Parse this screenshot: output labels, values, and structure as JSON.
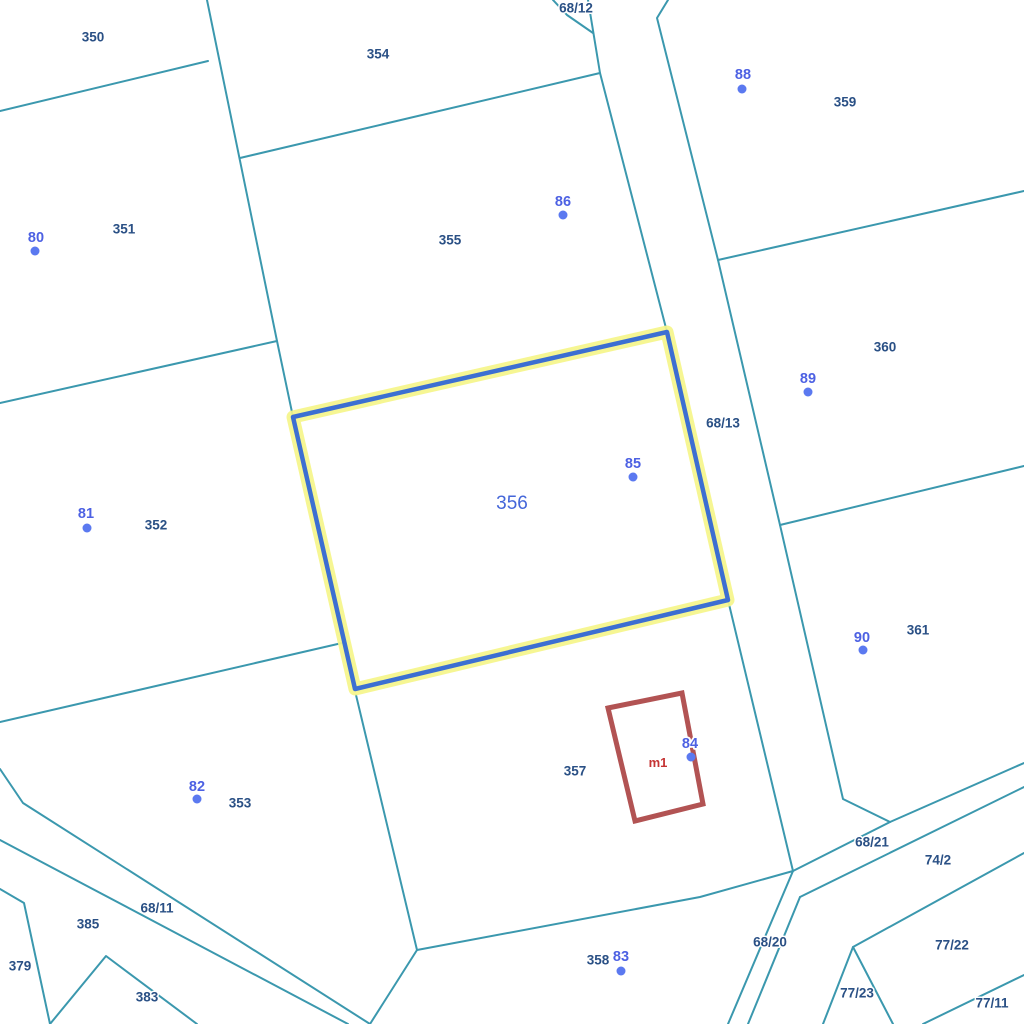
{
  "map": {
    "width": 1024,
    "height": 1024,
    "colors": {
      "background": "#ffffff",
      "boundary": "#3b98ae",
      "parcel_label": "#2a5085",
      "point_dot": "#5b79f0",
      "point_label": "#4d61e3",
      "highlight_stroke": "#3c6fd2",
      "highlight_halo": "#f5f58a",
      "building": "#b25353",
      "building_label": "#c53434",
      "selected_label": "#4466d9"
    },
    "boundaries": [
      {
        "name": "boundary-350-351",
        "points": [
          [
            0,
            111
          ],
          [
            208,
            61
          ]
        ]
      },
      {
        "name": "boundary-354-west",
        "points": [
          [
            207,
            0
          ],
          [
            277,
            341
          ],
          [
            293,
            417
          ]
        ]
      },
      {
        "name": "boundary-351-352",
        "points": [
          [
            0,
            403
          ],
          [
            277,
            341
          ]
        ]
      },
      {
        "name": "boundary-352-353",
        "points": [
          [
            0,
            722
          ],
          [
            342,
            643
          ]
        ]
      },
      {
        "name": "boundary-354-355",
        "points": [
          [
            240,
            158
          ],
          [
            600,
            73
          ]
        ]
      },
      {
        "name": "road-west-edge",
        "points": [
          [
            588,
            0
          ],
          [
            600,
            73
          ],
          [
            667,
            332
          ],
          [
            728,
            600
          ],
          [
            793,
            871
          ],
          [
            728,
            1024
          ]
        ]
      },
      {
        "name": "road-68-12-corner",
        "points": [
          [
            553,
            0
          ],
          [
            567,
            15
          ],
          [
            593,
            33
          ]
        ]
      },
      {
        "name": "road-east-edge",
        "points": [
          [
            668,
            0
          ],
          [
            657,
            18
          ],
          [
            718,
            260
          ],
          [
            780,
            525
          ],
          [
            843,
            799
          ],
          [
            890,
            822
          ]
        ]
      },
      {
        "name": "boundary-359-360",
        "points": [
          [
            718,
            260
          ],
          [
            1024,
            191
          ]
        ]
      },
      {
        "name": "boundary-360-361",
        "points": [
          [
            780,
            525
          ],
          [
            1024,
            466
          ]
        ]
      },
      {
        "name": "road-68-21-north-edge",
        "points": [
          [
            793,
            871
          ],
          [
            890,
            822
          ],
          [
            1024,
            763
          ]
        ]
      },
      {
        "name": "road-68-21-south-edge",
        "points": [
          [
            800,
            897
          ],
          [
            1024,
            787
          ]
        ]
      },
      {
        "name": "road-68-20-east-edge",
        "points": [
          [
            800,
            897
          ],
          [
            748,
            1024
          ]
        ]
      },
      {
        "name": "boundary-77-22-north",
        "points": [
          [
            1024,
            853
          ],
          [
            853,
            947
          ],
          [
            823,
            1024
          ]
        ]
      },
      {
        "name": "boundary-77-23-east",
        "points": [
          [
            853,
            947
          ],
          [
            893,
            1024
          ]
        ]
      },
      {
        "name": "boundary-77-11-north",
        "points": [
          [
            923,
            1024
          ],
          [
            1024,
            975
          ]
        ]
      },
      {
        "name": "boundary-357-358",
        "points": [
          [
            417,
            950
          ],
          [
            700,
            897
          ],
          [
            793,
            871
          ]
        ]
      },
      {
        "name": "boundary-353-357",
        "points": [
          [
            356,
            695
          ],
          [
            417,
            950
          ],
          [
            370,
            1024
          ]
        ]
      },
      {
        "name": "road-68-11-north-edge",
        "points": [
          [
            0,
            769
          ],
          [
            23,
            803
          ],
          [
            370,
            1024
          ]
        ]
      },
      {
        "name": "road-68-11-south-edge",
        "points": [
          [
            0,
            840
          ],
          [
            348,
            1024
          ]
        ]
      },
      {
        "name": "boundary-379-east",
        "points": [
          [
            0,
            889
          ],
          [
            24,
            903
          ],
          [
            50,
            1024
          ]
        ]
      },
      {
        "name": "boundary-383-triangle",
        "points": [
          [
            50,
            1024
          ],
          [
            106,
            956
          ],
          [
            197,
            1024
          ]
        ]
      }
    ],
    "highlighted_parcel": {
      "id": "356",
      "label": "356",
      "label_x": 512,
      "label_y": 503,
      "points": [
        [
          293,
          417
        ],
        [
          667,
          332
        ],
        [
          728,
          600
        ],
        [
          355,
          689
        ]
      ]
    },
    "building": {
      "id": "m1",
      "label": "m1",
      "label_x": 658,
      "label_y": 763,
      "points": [
        [
          608,
          708
        ],
        [
          682,
          693
        ],
        [
          703,
          804
        ],
        [
          635,
          821
        ]
      ]
    },
    "parcel_labels": [
      {
        "text": "350",
        "x": 93,
        "y": 37
      },
      {
        "text": "351",
        "x": 124,
        "y": 229
      },
      {
        "text": "352",
        "x": 156,
        "y": 525
      },
      {
        "text": "353",
        "x": 240,
        "y": 803
      },
      {
        "text": "354",
        "x": 378,
        "y": 54
      },
      {
        "text": "355",
        "x": 450,
        "y": 240
      },
      {
        "text": "357",
        "x": 575,
        "y": 771
      },
      {
        "text": "358",
        "x": 598,
        "y": 960
      },
      {
        "text": "359",
        "x": 845,
        "y": 102
      },
      {
        "text": "360",
        "x": 885,
        "y": 347
      },
      {
        "text": "361",
        "x": 918,
        "y": 630
      },
      {
        "text": "379",
        "x": 20,
        "y": 966
      },
      {
        "text": "383",
        "x": 147,
        "y": 997
      },
      {
        "text": "385",
        "x": 88,
        "y": 924
      },
      {
        "text": "68/12",
        "x": 576,
        "y": 8
      },
      {
        "text": "68/13",
        "x": 723,
        "y": 423
      },
      {
        "text": "68/11",
        "x": 157,
        "y": 908
      },
      {
        "text": "68/21",
        "x": 872,
        "y": 842
      },
      {
        "text": "68/20",
        "x": 770,
        "y": 942
      },
      {
        "text": "74/2",
        "x": 938,
        "y": 860
      },
      {
        "text": "77/22",
        "x": 952,
        "y": 945
      },
      {
        "text": "77/23",
        "x": 857,
        "y": 993
      },
      {
        "text": "77/11",
        "x": 992,
        "y": 1003
      }
    ],
    "survey_points": [
      {
        "id": "80",
        "label_x": 36,
        "label_y": 237,
        "dot_x": 35,
        "dot_y": 251
      },
      {
        "id": "81",
        "label_x": 86,
        "label_y": 513,
        "dot_x": 87,
        "dot_y": 528
      },
      {
        "id": "82",
        "label_x": 197,
        "label_y": 786,
        "dot_x": 197,
        "dot_y": 799
      },
      {
        "id": "83",
        "label_x": 621,
        "label_y": 956,
        "dot_x": 621,
        "dot_y": 971
      },
      {
        "id": "84",
        "label_x": 690,
        "label_y": 743,
        "dot_x": 691,
        "dot_y": 757
      },
      {
        "id": "85",
        "label_x": 633,
        "label_y": 463,
        "dot_x": 633,
        "dot_y": 477
      },
      {
        "id": "86",
        "label_x": 563,
        "label_y": 201,
        "dot_x": 563,
        "dot_y": 215
      },
      {
        "id": "88",
        "label_x": 743,
        "label_y": 74,
        "dot_x": 742,
        "dot_y": 89
      },
      {
        "id": "89",
        "label_x": 808,
        "label_y": 378,
        "dot_x": 808,
        "dot_y": 392
      },
      {
        "id": "90",
        "label_x": 862,
        "label_y": 637,
        "dot_x": 863,
        "dot_y": 650
      }
    ]
  }
}
